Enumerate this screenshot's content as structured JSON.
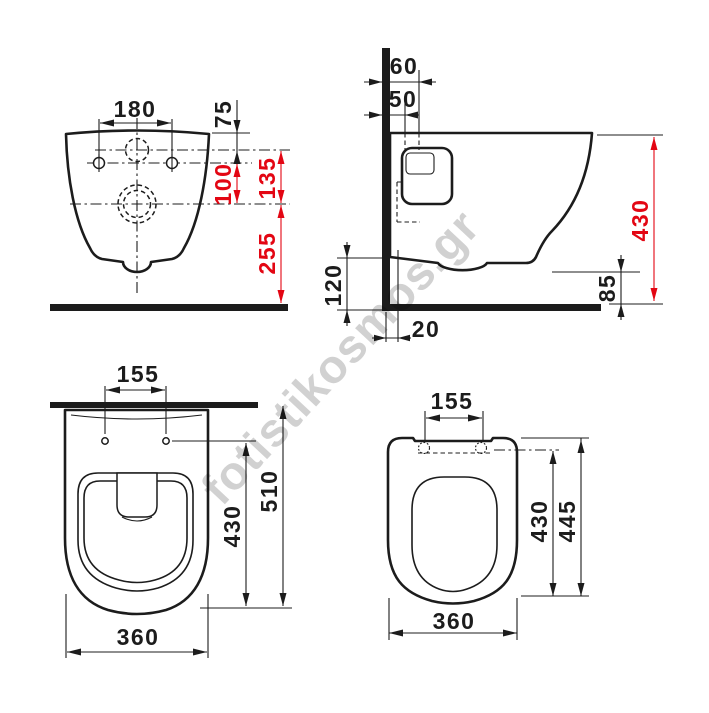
{
  "watermark": {
    "text": "fotistikosmos.gr"
  },
  "colors": {
    "line": "#1c1c1c",
    "dimension_red": "#e30613",
    "watermark_gray": "#c9c9c9"
  },
  "front_view": {
    "fixing_hole_spacing": "180",
    "top_to_inlet": "75",
    "fixings_to_drain": "100",
    "inlet_to_drain": "135",
    "drain_to_floor": "255"
  },
  "side_view": {
    "wall_to_inlet_far": "60",
    "wall_to_inlet": "50",
    "total_height": "430",
    "underside_to_floor": "120",
    "front_edge_to_floor": "85",
    "wall_to_drain": "20"
  },
  "bowl_view": {
    "fixing_hole_spacing": "155",
    "fixings_to_front": "430",
    "wall_to_front": "510",
    "width": "360"
  },
  "seat_view": {
    "hinge_spacing": "155",
    "hinge_to_front": "430",
    "total_depth": "445",
    "width": "360"
  }
}
